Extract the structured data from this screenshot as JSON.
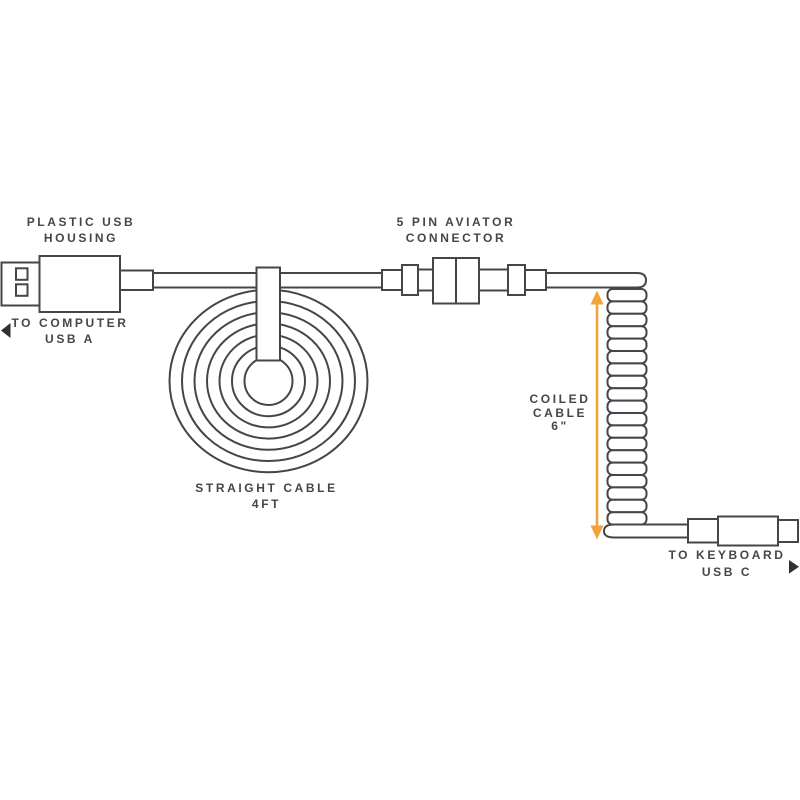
{
  "colors": {
    "line_gray": "#43464A",
    "text_gray": "#43464A",
    "accent_orange": "#F2A33C",
    "background": "#FFFFFF"
  },
  "annotations": {
    "usb_housing": {
      "line1": "PLASTIC USB",
      "line2": "HOUSING"
    },
    "computer_end": {
      "line1": "TO COMPUTER",
      "line2": "USB A"
    },
    "aviator_connector": {
      "line1": "5 PIN AVIATOR",
      "line2": "CONNECTOR"
    },
    "straight_cable": {
      "line1": "STRAIGHT CABLE",
      "line2": "4FT"
    },
    "coiled_cable": {
      "line1": "COILED",
      "line2": "CABLE",
      "line3": "6\""
    },
    "keyboard_end": {
      "line1": "TO KEYBOARD",
      "line2": "USB C"
    }
  }
}
